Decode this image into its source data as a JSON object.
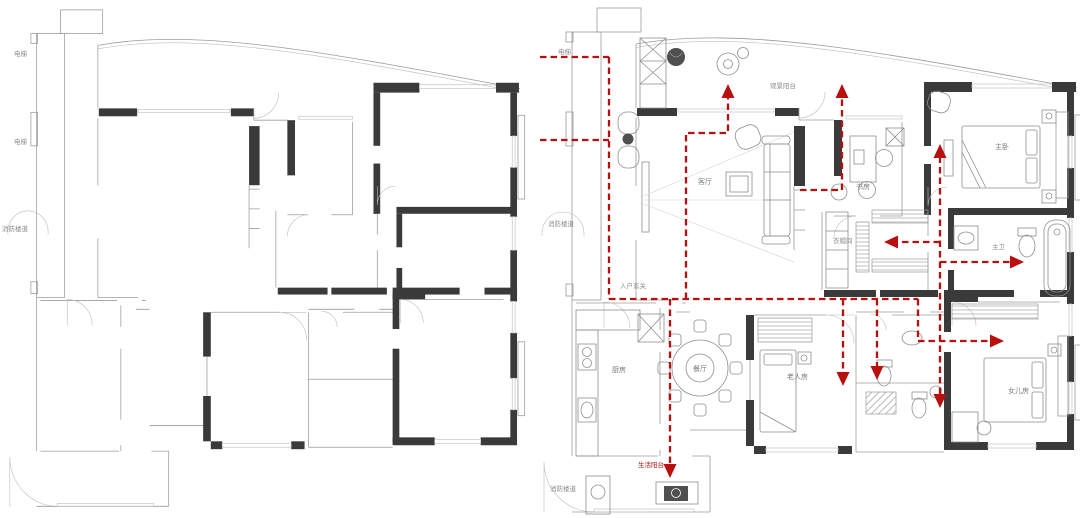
{
  "canvas": {
    "width": 1080,
    "height": 518,
    "background": "#ffffff"
  },
  "colors": {
    "wall": "#3a3a3a",
    "outline": "#9c9c9c",
    "window": "#c3c3c3",
    "furniture": "#8f8f8f",
    "flow_line": "#b90f0f",
    "label_gray": "#8a8a8a",
    "label_red": "#b90f0f"
  },
  "left_plan": {
    "description": "original empty floor plan",
    "labels": {
      "elevator_upper": "电梯",
      "elevator_lower": "电梯",
      "fire_stair": "消防楼道"
    }
  },
  "right_plan": {
    "description": "furnished floor plan with red dashed circulation arrows",
    "labels": {
      "elevator": "电梯",
      "fire_stair": "消防楼道",
      "entry": "入户玄关",
      "view_balcony": "观景阳台",
      "living": "客厅",
      "study": "书房",
      "master": "主卧",
      "closet": "衣帽间",
      "master_bath": "主卫",
      "dining": "餐厅",
      "kitchen": "厨房",
      "elder_room": "老人房",
      "daughter_room": "女儿房",
      "service_balcony": "生活阳台",
      "fire_stair_bottom": "消防楼道"
    },
    "flow": {
      "color": "#b90f0f",
      "line_style": "dashed",
      "arrow_count": 10
    }
  }
}
